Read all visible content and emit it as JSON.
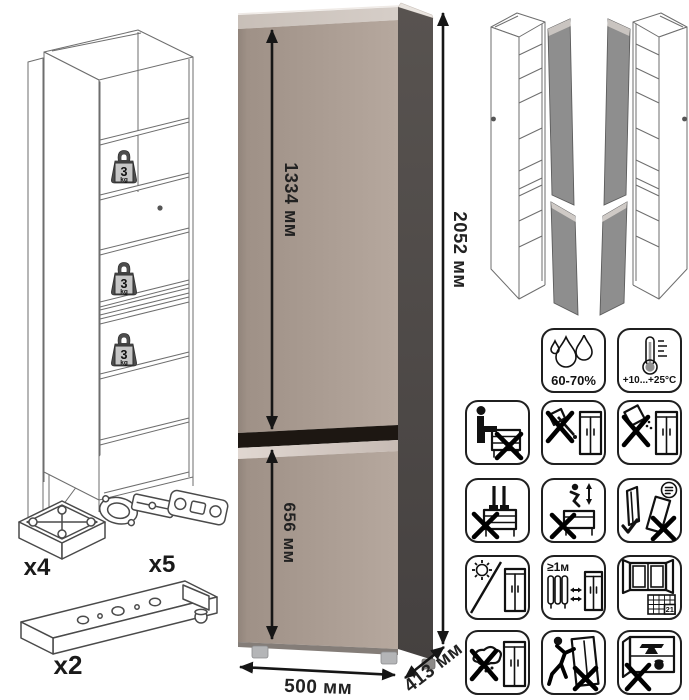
{
  "product": {
    "dimensions": {
      "total_height": "2052 мм",
      "upper_door_height": "1334 мм",
      "lower_door_height": "656 мм",
      "width": "500 мм",
      "depth": "413 мм"
    },
    "shelf_load": {
      "value": "3",
      "unit": "kg"
    },
    "colors": {
      "front": "#ab9c92",
      "side": "#4d4845",
      "top_edge": "#d0c7c0",
      "groove": "#1d1712",
      "bevel": "#d8cec8"
    }
  },
  "hardware": [
    {
      "name": "adjustable-foot",
      "qty": "x4"
    },
    {
      "name": "concealed-hinge",
      "qty": "x5"
    },
    {
      "name": "mounting-rail",
      "qty": "x2"
    }
  ],
  "climate_icons": [
    {
      "name": "humidity-icon",
      "label": "60-70%"
    },
    {
      "name": "temperature-icon",
      "label": "+10...+25°C"
    }
  ],
  "care_icons": {
    "labels": {
      "min_heater_distance": "≥1м",
      "calendar_day": "21"
    },
    "names": [
      "no-sitting",
      "no-sharp-tools",
      "no-abrasives",
      "no-standing",
      "no-jumping",
      "transport-check",
      "avoid-sunlight",
      "heater-distance",
      "ventilation-calendar",
      "no-wet-cleaning",
      "no-dragging",
      "no-heavy-items"
    ]
  }
}
